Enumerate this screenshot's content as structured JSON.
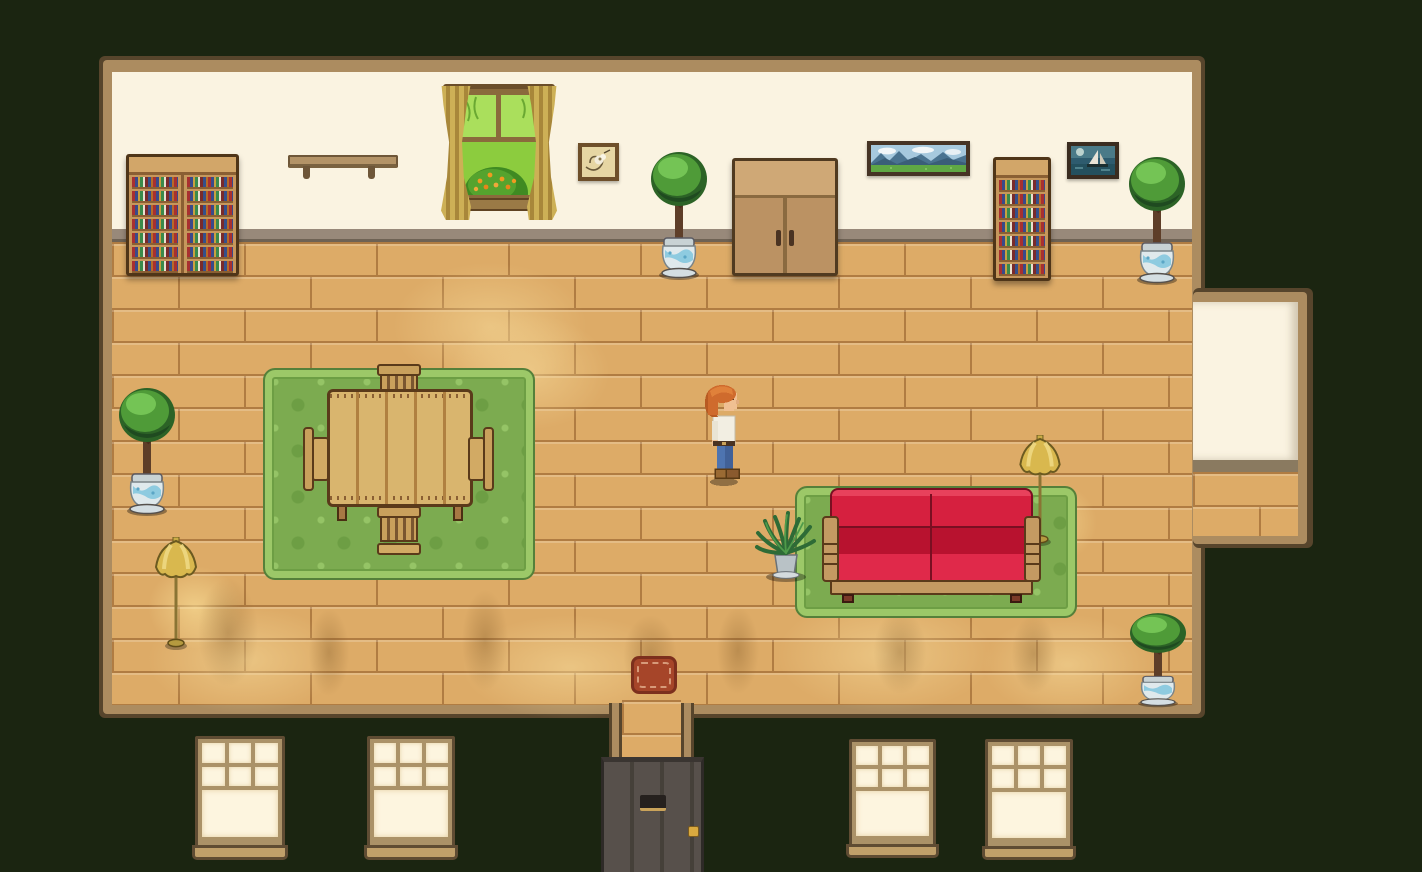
{
  "scene": {
    "title": "Cozy pixel-art house interior, top-down game view at night",
    "labels": {
      "room": "living room interior",
      "player": "player character with orange hair, white shirt and jeans",
      "front_door": "front door with mail slot and brass knob",
      "doormat": "red doormat",
      "wardrobe": "wooden double-door wardrobe",
      "double_bookshelf": "wide double bookshelf full of colored books",
      "single_bookshelf": "narrow bookshelf full of colored books",
      "wall_shelf": "empty wall shelf",
      "garden_window": "window with gold curtains and a flowering bush outside",
      "drawing_picture": "small framed sketch",
      "landscape_painting": "wide framed mountain landscape painting",
      "sailboat_painting": "small framed sailboat painting",
      "potted_tree": "potted tree in blue ceramic pot",
      "fern_plant": "leafy fern plant in a pot",
      "dining_rug": "green patterned area rug",
      "dining_table": "wooden plank dining table",
      "chair_top": "wooden chair, top side of table",
      "chair_bottom": "wooden chair, bottom side of table",
      "chair_left": "wooden chair, left side of table",
      "chair_right": "wooden chair, right side of table",
      "couch_rug": "green area rug under couch",
      "red_couch": "red cushioned couch with wooden arms",
      "floor_lamp": "brass floor lamp",
      "facade_window": "lit exterior window",
      "alcove": "recessed alcove in right wall"
    },
    "objects": [
      {
        "name": "potted-tree",
        "count": 4
      },
      {
        "name": "floor-lamp",
        "count": 2
      },
      {
        "name": "facade-window",
        "count": 4
      },
      {
        "name": "chair",
        "count": 4
      },
      {
        "name": "bookshelf",
        "count": 2
      },
      {
        "name": "rug",
        "count": 2
      }
    ],
    "palette": {
      "bg_outside": "#1b2511",
      "trim": "#ac8c60",
      "trim_dark": "#57452c",
      "wall": "#faf3e1",
      "baseboard": "#98897a",
      "floor_base": "#ddab67",
      "floor_line": "#b07c42",
      "rug_body": "#7cab50",
      "rug_border": "#9cc868",
      "rug_pattern": "#6d9e44",
      "couch_red": "#d6203f",
      "couch_red_dark": "#b8122f",
      "wood_mid": "#d9b56e",
      "lamp_gold": "#d9b84e",
      "door_gray": "#57504b",
      "mat_red": "#a64529",
      "pane_cream": "#fdf5df",
      "win_frame": "#ab9268",
      "tree_green": "#4f9b38",
      "pot_blue": "#8ecbe0",
      "hair_orange": "#cf6b2d",
      "shirt_white": "#f2eee2",
      "jeans_blue": "#4e74b0"
    }
  }
}
